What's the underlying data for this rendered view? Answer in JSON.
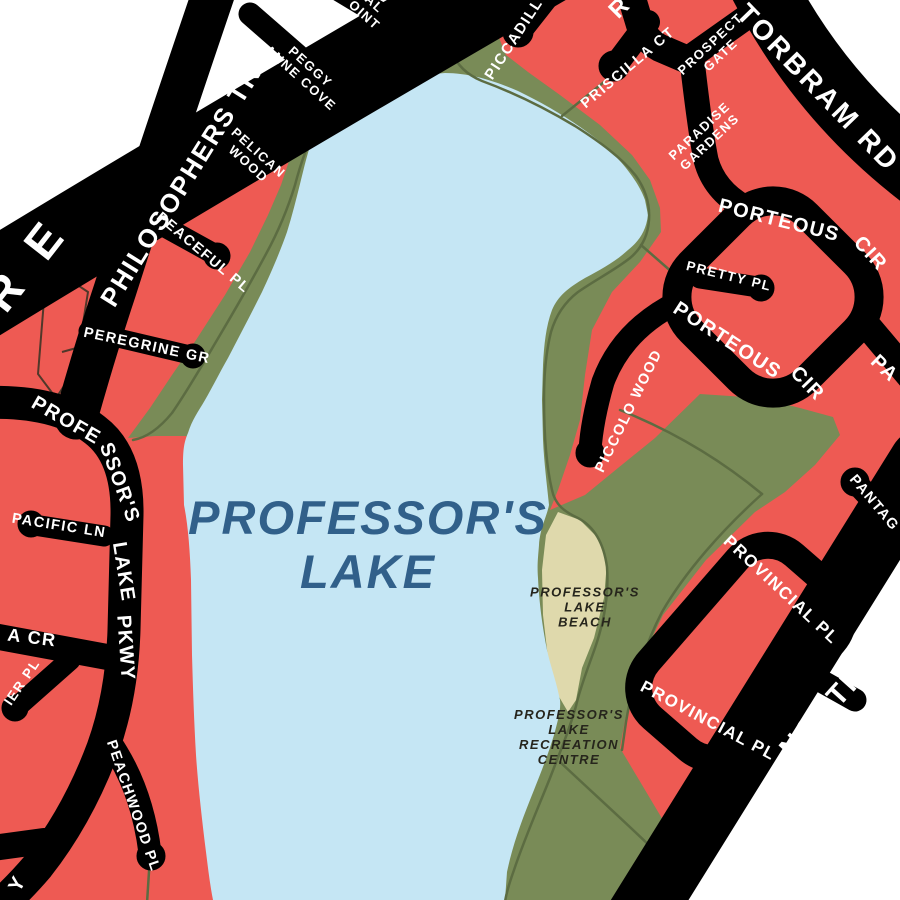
{
  "map": {
    "region_label": "Professor's Lake neighbourhood map",
    "colors": {
      "residential": "#EE5A53",
      "road": "#000000",
      "road_text": "#FFFFFF",
      "water": "#C5E6F4",
      "water_text": "#31608A",
      "park": "#798B57",
      "trail": "#5C6C42",
      "sand": "#DFD9AC",
      "place_text": "#26251C",
      "parcel_line": "#50382A",
      "outside": "#FFFFFF"
    },
    "lake": {
      "line1": "PROFESSOR'S",
      "line2": "LAKE"
    },
    "beach": {
      "line1": "PROFESSOR'S",
      "line2": "LAKE",
      "line3": "BEACH"
    },
    "recreation_centre": {
      "line1": "PROFESSOR'S",
      "line2": "LAKE",
      "line3": "RECREATION",
      "line4": "CENTRE"
    },
    "streets": {
      "bovaird_fragment": "R E",
      "philosophers": "PHILOSOPHERS TR",
      "torbram": "TORBRAM RD",
      "north_park_fragment": "NORTH PA",
      "pkwy": {
        "seg1": "PROFE",
        "seg2": "SSOR'S",
        "seg3": "LAKE",
        "seg4": "PKWY",
        "tail_fragment": "Y"
      },
      "peggy_anne": {
        "line1": "PEGGY",
        "line2": "ANNE COVE"
      },
      "al_point": {
        "line1": "AL",
        "line2": "OINT"
      },
      "pelican": {
        "line1": "PELICAN",
        "line2": "WOOD"
      },
      "peaceful": "PEACEFUL PL",
      "peregrine": "PEREGRINE GR",
      "pacific": "PACIFIC LN",
      "a_cr_fragment": "A CR",
      "ier_pl_fragment": "IER PL",
      "peachwood": "PEACHWOOD PL",
      "piccadilly_fragment": "PICCADILL",
      "r_fragment": "R",
      "priscilla": "PRISCILLA CT",
      "prospect": {
        "line1": "PROSPECT",
        "line2": "GATE"
      },
      "paradise": {
        "line1": "PARADISE",
        "line2": "GARDENS"
      },
      "porteous_top": {
        "part1": "PORTEOUS",
        "part2": "CIR"
      },
      "porteous_bottom": {
        "part1": "PORTEOUS",
        "part2": "CIR"
      },
      "pretty": "PRETTY PL",
      "piccolo": "PICCOLO WOOD",
      "pa_fragment": "PA",
      "pantag_fragment": "PANTAG",
      "provincial_upper": "PROVINCIAL PL",
      "provincial_lower": "PROVINCIAL PL"
    }
  }
}
